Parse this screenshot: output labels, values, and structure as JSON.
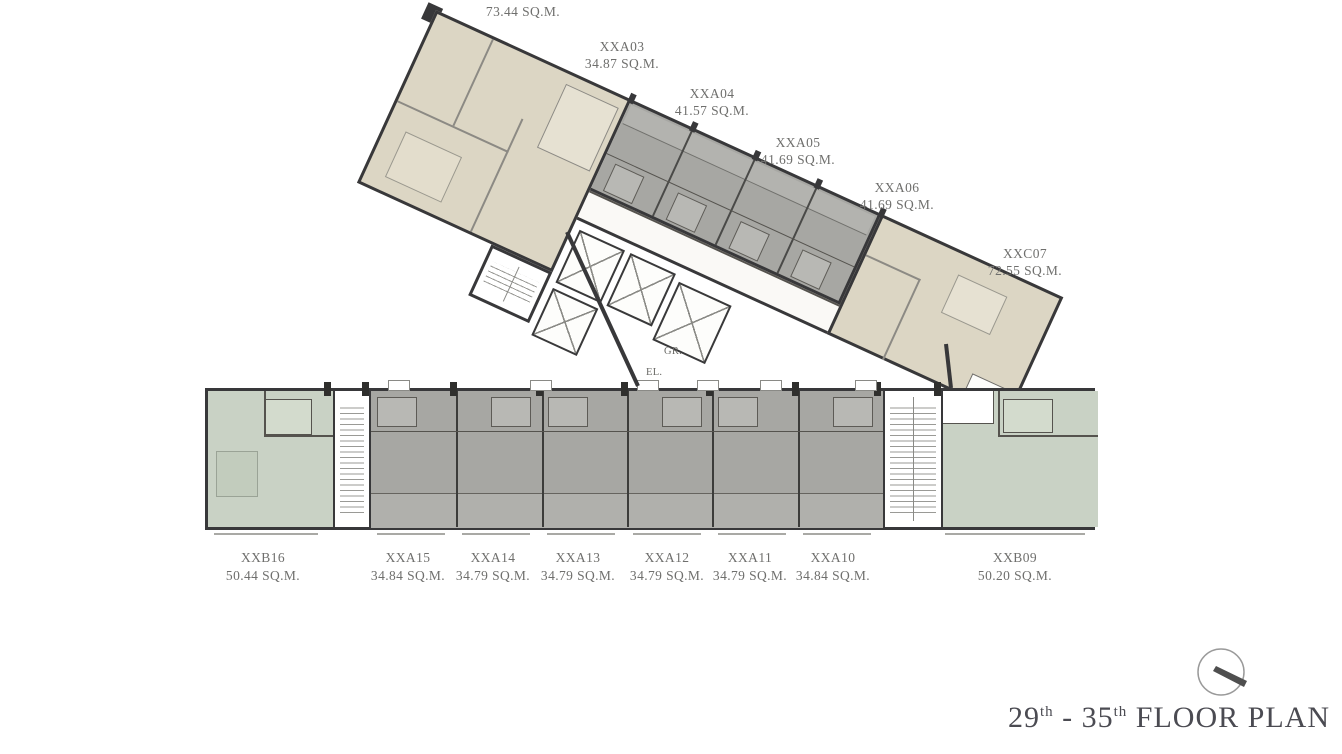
{
  "plan": {
    "name": "condominium floor plan",
    "title_parts": {
      "n1": "29",
      "s1": "th",
      "mid": " - ",
      "n2": "35",
      "s2": "th",
      "rest": " FLOOR PLAN"
    },
    "upper_units": [
      {
        "id": "",
        "area": "73.44 SQ.M."
      },
      {
        "id": "XXA03",
        "area": "34.87 SQ.M."
      },
      {
        "id": "XXA04",
        "area": "41.57 SQ.M."
      },
      {
        "id": "XXA05",
        "area": "41.69 SQ.M."
      },
      {
        "id": "XXA06",
        "area": "41.69 SQ.M."
      },
      {
        "id": "XXC07",
        "area": "72.55 SQ.M."
      }
    ],
    "lower_units": [
      {
        "id": "XXB16",
        "area": "50.44 SQ.M."
      },
      {
        "id": "XXA15",
        "area": "34.84 SQ.M."
      },
      {
        "id": "XXA14",
        "area": "34.79 SQ.M."
      },
      {
        "id": "XXA13",
        "area": "34.79 SQ.M."
      },
      {
        "id": "XXA12",
        "area": "34.79 SQ.M."
      },
      {
        "id": "XXA11",
        "area": "34.79 SQ.M."
      },
      {
        "id": "XXA10",
        "area": "34.84 SQ.M."
      },
      {
        "id": "XXB09",
        "area": "50.20 SQ.M."
      }
    ],
    "core": {
      "gr": "GR.",
      "el": "EL."
    },
    "colors": {
      "gray_unit": "#a7a7a3",
      "cream_unit": "#dcd6c4",
      "green_unit": "#c9d2c5",
      "wall": "#38383a",
      "label_text": "#6f6f6d",
      "title_text": "#4b4b52"
    }
  }
}
